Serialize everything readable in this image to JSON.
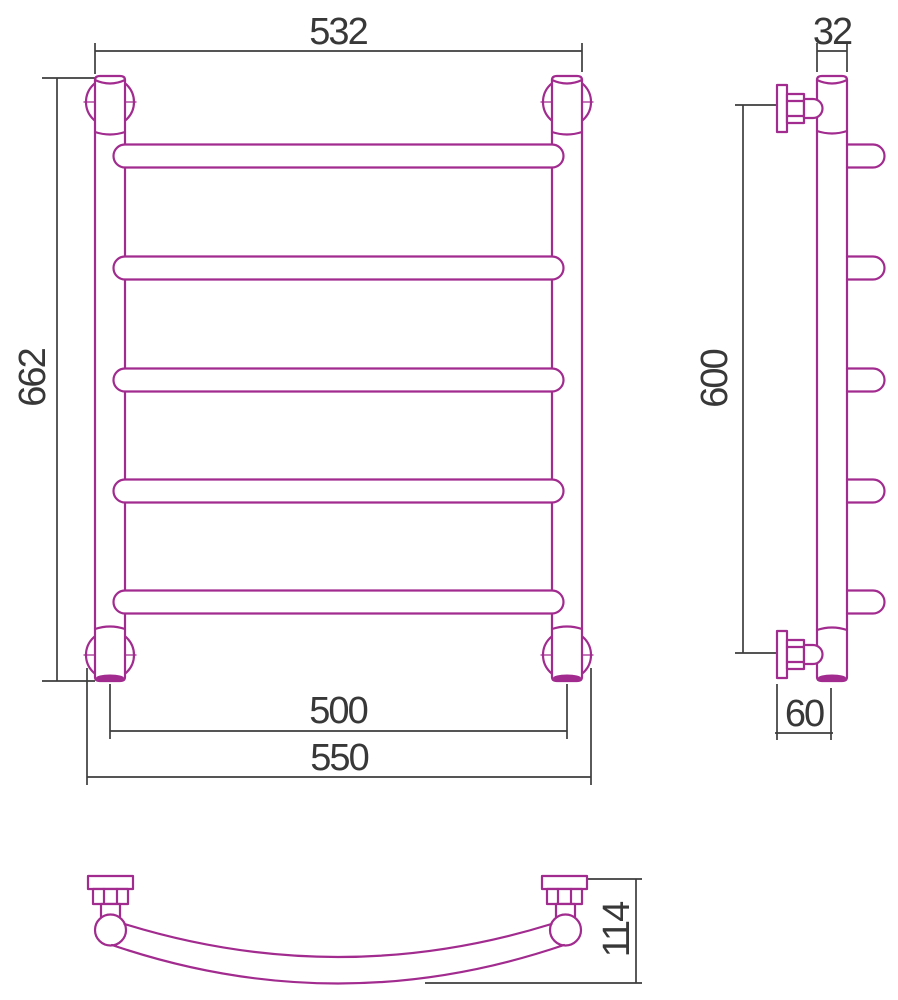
{
  "title": "Towel rail technical drawing, three views",
  "colors": {
    "outline": "#a12b8e",
    "dimension": "#3d3d3d"
  },
  "views": {
    "front": {
      "label": "front-view",
      "dimensions": {
        "top_width": "532",
        "overall_height": "662",
        "rail_center_width": "500",
        "overall_width": "550"
      }
    },
    "side": {
      "label": "side-view",
      "dimensions": {
        "tube_diameter": "32",
        "mount_spacing": "600",
        "wall_offset": "60"
      }
    },
    "plan": {
      "label": "plan-view",
      "dimensions": {
        "depth": "114"
      }
    }
  }
}
